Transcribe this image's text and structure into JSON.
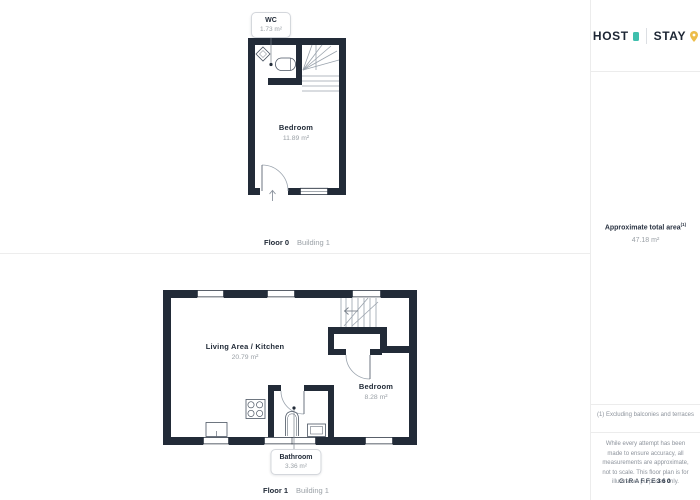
{
  "brand": {
    "host": "HOST",
    "stay": "STAY"
  },
  "sidebar": {
    "total_area_label": "Approximate total area",
    "total_area_sup": "(1)",
    "total_area_value": "47.18 m²",
    "footnote": "(1) Excluding balconies and terraces",
    "disclaimer": "While every attempt has been made to ensure accuracy, all measurements are approximate, not to scale. This floor plan is for illustrative purposes only.",
    "giraffe_brand": "GIRAFFE",
    "giraffe_360": "360"
  },
  "floor0": {
    "floor_label": "Floor 0",
    "building_label": "Building 1",
    "rooms": {
      "wc": {
        "name": "WC",
        "area": "1.73 m²"
      },
      "bedroom": {
        "name": "Bedroom",
        "area": "11.89 m²"
      }
    }
  },
  "floor1": {
    "floor_label": "Floor 1",
    "building_label": "Building 1",
    "rooms": {
      "living": {
        "name": "Living Area / Kitchen",
        "area": "20.79 m²"
      },
      "bedroom": {
        "name": "Bedroom",
        "area": "8.28 m²"
      },
      "bathroom": {
        "name": "Bathroom",
        "area": "3.36 m²"
      }
    }
  },
  "colors": {
    "wall": "#222B38",
    "accent_teal": "#3FBFAD",
    "accent_gold": "#ECBD4B",
    "text_dark": "#222B38",
    "text_gray": "#9AA0A6"
  }
}
